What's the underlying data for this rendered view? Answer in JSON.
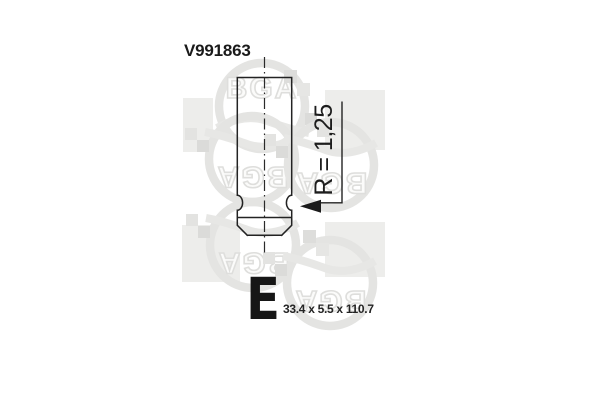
{
  "part": {
    "number": "V991863",
    "radius_label": "R = 1,25",
    "type_letter": "E",
    "dimensions": "33.4 x 5.5 x 110.7"
  },
  "watermark": {
    "text": "BGA"
  },
  "colors": {
    "background": "#ffffff",
    "drawing_line": "#222222",
    "text": "#1a1a1a",
    "watermark_square": "#ededeb",
    "watermark_ring": "#e4e4e2",
    "watermark_checker": "#dbdbd9"
  }
}
